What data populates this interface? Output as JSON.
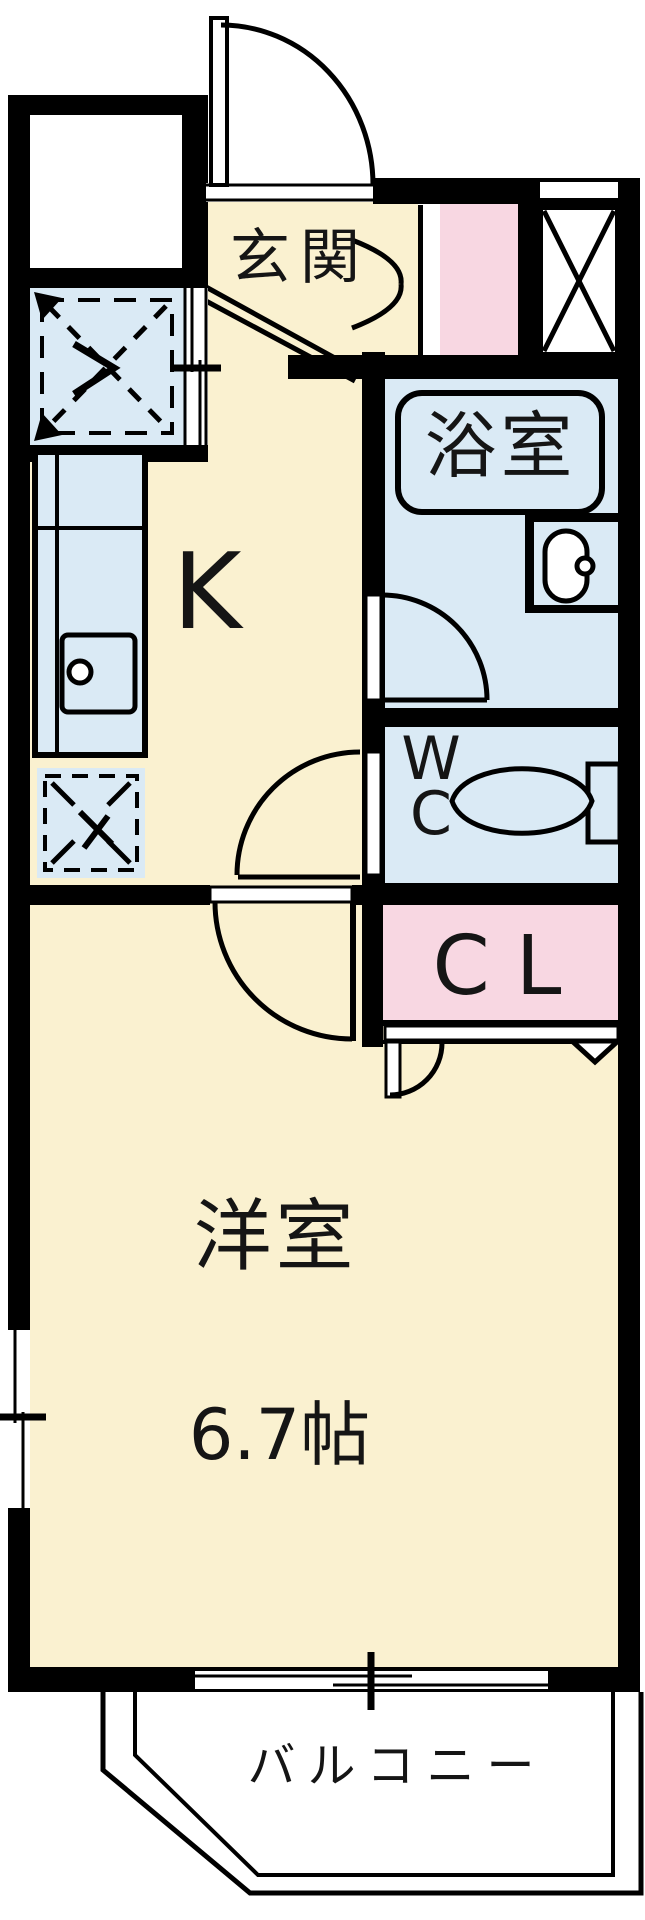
{
  "plan_title": "1K apartment floor plan",
  "rooms": {
    "genkan": {
      "label": "玄関"
    },
    "kitchen": {
      "label": "K"
    },
    "bath": {
      "label": "浴室"
    },
    "wc": {
      "label_lines": [
        "W",
        "C"
      ]
    },
    "closet": {
      "label": "CL"
    },
    "western_room": {
      "label": "洋室",
      "size": "6.7帖"
    },
    "balcony": {
      "label": "バルコニー"
    }
  },
  "colors": {
    "wall": "#000000",
    "floor": "#FAF1D0",
    "wet": "#DAEAF5",
    "pink": "#F8D7E2",
    "ink": "#151515"
  }
}
